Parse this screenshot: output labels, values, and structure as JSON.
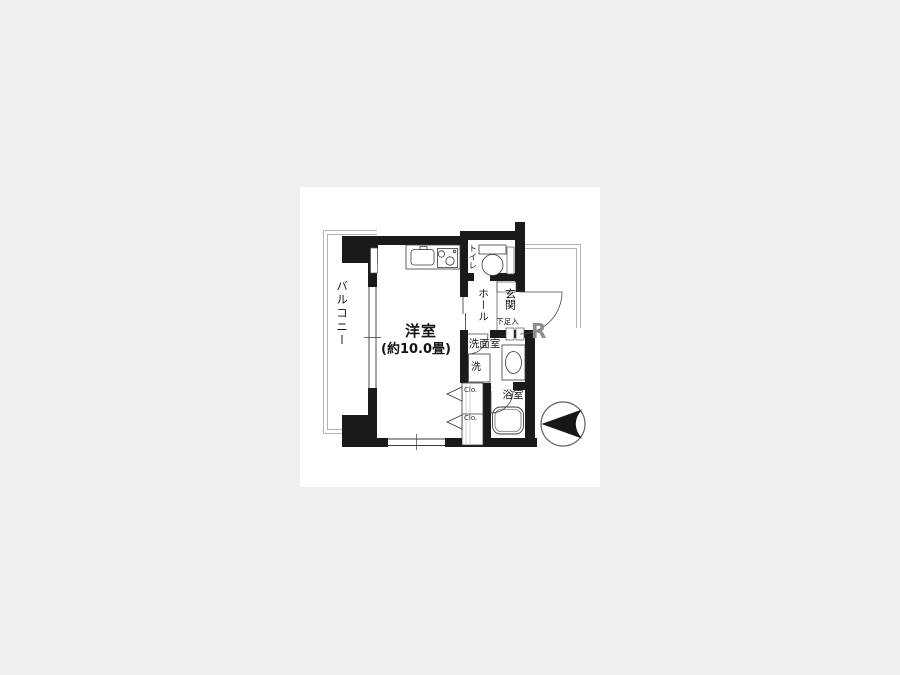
{
  "canvas": {
    "background": "#efefef",
    "panel_background": "#ffffff"
  },
  "floorplan": {
    "type": "apartment-floorplan",
    "rooms": {
      "balcony": {
        "label": "バルコニー"
      },
      "main_room": {
        "label": "洋室",
        "size_note": "(約10.0畳)"
      },
      "toilet": {
        "label": "トイレ"
      },
      "hall": {
        "label": "ホール"
      },
      "entrance": {
        "label": "玄関"
      },
      "shoe_storage": {
        "label": "下足入"
      },
      "washroom": {
        "label": "洗面室"
      },
      "washer_space": {
        "label": "洗"
      },
      "bathroom": {
        "label": "浴室"
      },
      "closet_upper": {
        "label": "Clo."
      },
      "closet_lower": {
        "label": "Clo."
      }
    },
    "watermark_fragment": "R",
    "compass": {
      "style": "circle-arrow",
      "pointing": "left"
    },
    "colors": {
      "wall": "#1a1a1a",
      "fixture_line": "#3a3a3a",
      "outline_gray": "#b3b3b3",
      "text": "#141414"
    }
  }
}
